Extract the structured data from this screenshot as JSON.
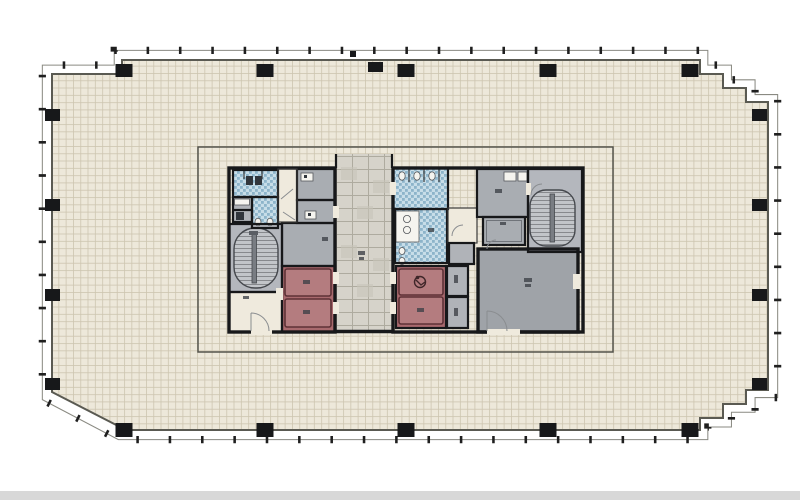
{
  "plan": {
    "perimeter_columns": 18,
    "elevator_cars": 4,
    "accessible_elevator_cars": 1,
    "stairwells": 2,
    "restroom_blocks": 2,
    "corridor": 1
  },
  "colors": {
    "paper": "#ffffff",
    "floor": "#ede8da",
    "floor-line": "#cdc5b0",
    "wall": "#17181a",
    "outline": "#5a5a52",
    "zone-line": "#55544c",
    "mullion": "#8a8a82",
    "tick": "#1f1f1f",
    "room-grey": "#a9adb2",
    "room-grey-light": "#b0b3b8",
    "room-grey-dark": "#9fa3a8",
    "stair-grey": "#b4b7bd",
    "stair-tread": "#c2c5c9",
    "stair-tread-line": "#87898d",
    "mosaic-base": "#c7dde8",
    "mosaic-tile": "#8db4ca",
    "elevator-shaft": "#a96a6e",
    "elevator-car": "#b47c7f",
    "elevator-line": "#5e3136",
    "stone-base": "#d6d3ca",
    "stone-line": "#aeab9f",
    "cream": "#efeadd",
    "fixture": "#f5f4ef",
    "smudge": "#3c4046",
    "door-arc": "#8a8d90",
    "scan-strip": "#d8d8d8"
  }
}
